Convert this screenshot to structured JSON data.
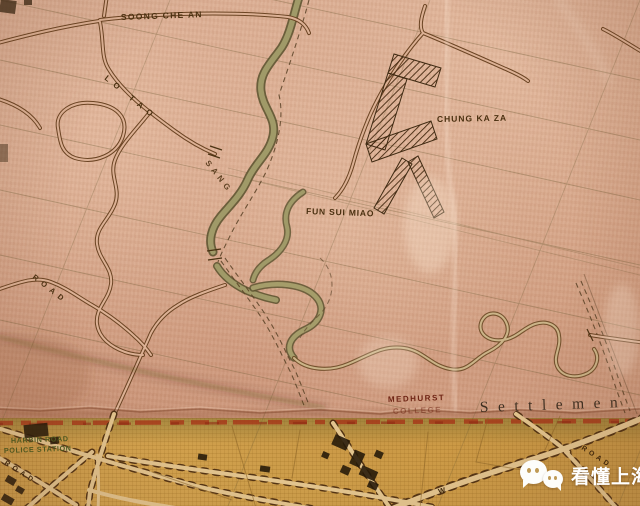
{
  "map": {
    "place_labels": {
      "soong_che_an": "SOONG CHE AN",
      "chung_ka_za": "CHUNG KA ZA",
      "fun_sui_miao": "FUN SUI MIAO",
      "medhurst": "MEDHURST",
      "college": "COLLEGE",
      "settlement": "Settlemen",
      "harbin_road": "HARBIN ROAD",
      "police_station": "POLICE STATION"
    },
    "road_labels": {
      "lo_tao": "LO TAO",
      "sang": "SANG",
      "road_left": "ROAD",
      "road_corner": "ROAD",
      "road_right": "ROAD",
      "letter_w": "W"
    },
    "colors": {
      "paper_pink": "#d7a88d",
      "settlement_ochre": "#c69645",
      "boundary_red": "#a63418",
      "ink_brown": "#4a3010",
      "river_olive": "#a09a68",
      "college_red": "#6e2414",
      "station_green": "#4a5a1e"
    }
  },
  "watermark": {
    "text": "看懂上海"
  }
}
